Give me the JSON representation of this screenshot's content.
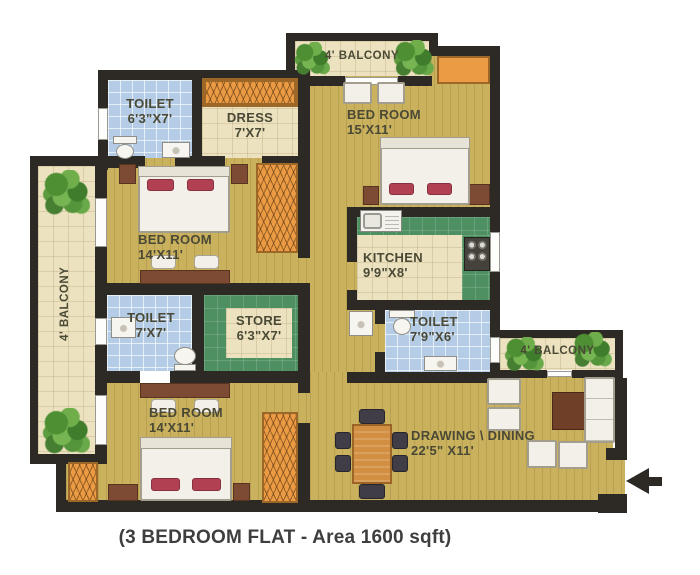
{
  "caption": "(3 BEDROOM FLAT - Area 1600 sqft)",
  "rooms": {
    "toilet_top": {
      "name": "TOILET",
      "size": "6'3\"X7'"
    },
    "dress": {
      "name": "DRESS",
      "size": "7'X7'"
    },
    "bedroom_top_right": {
      "name": "BED ROOM",
      "size": "15'X11'"
    },
    "kitchen": {
      "name": "KITCHEN",
      "size": "9'9\"X8'"
    },
    "toilet_right": {
      "name": "TOILET",
      "size": "7'9\"X6'"
    },
    "bedroom_middle": {
      "name": "BED ROOM",
      "size": "14'X11'"
    },
    "toilet_middle": {
      "name": "TOILET",
      "size": "7'X7'"
    },
    "store": {
      "name": "STORE",
      "size": "6'3\"X7'"
    },
    "bedroom_bottom": {
      "name": "BED ROOM",
      "size": "14'X11'"
    },
    "drawing_dining": {
      "name": "DRAWING \\ DINING",
      "size": "22'5\" X11'"
    }
  },
  "balconies": {
    "top": "4' BALCONY",
    "left": "4' BALCONY",
    "right": "4' BALCONY"
  },
  "colors": {
    "wall": "#2d2a26",
    "floor_wood": "#c9b15e",
    "tile_blue": "#b5cce6",
    "counter_green": "#4f9062",
    "floor_cream": "#ece2c0",
    "wardrobe_orange": "#eb9b44",
    "pillow_red": "#b24053",
    "label_text": "#4a4936"
  }
}
